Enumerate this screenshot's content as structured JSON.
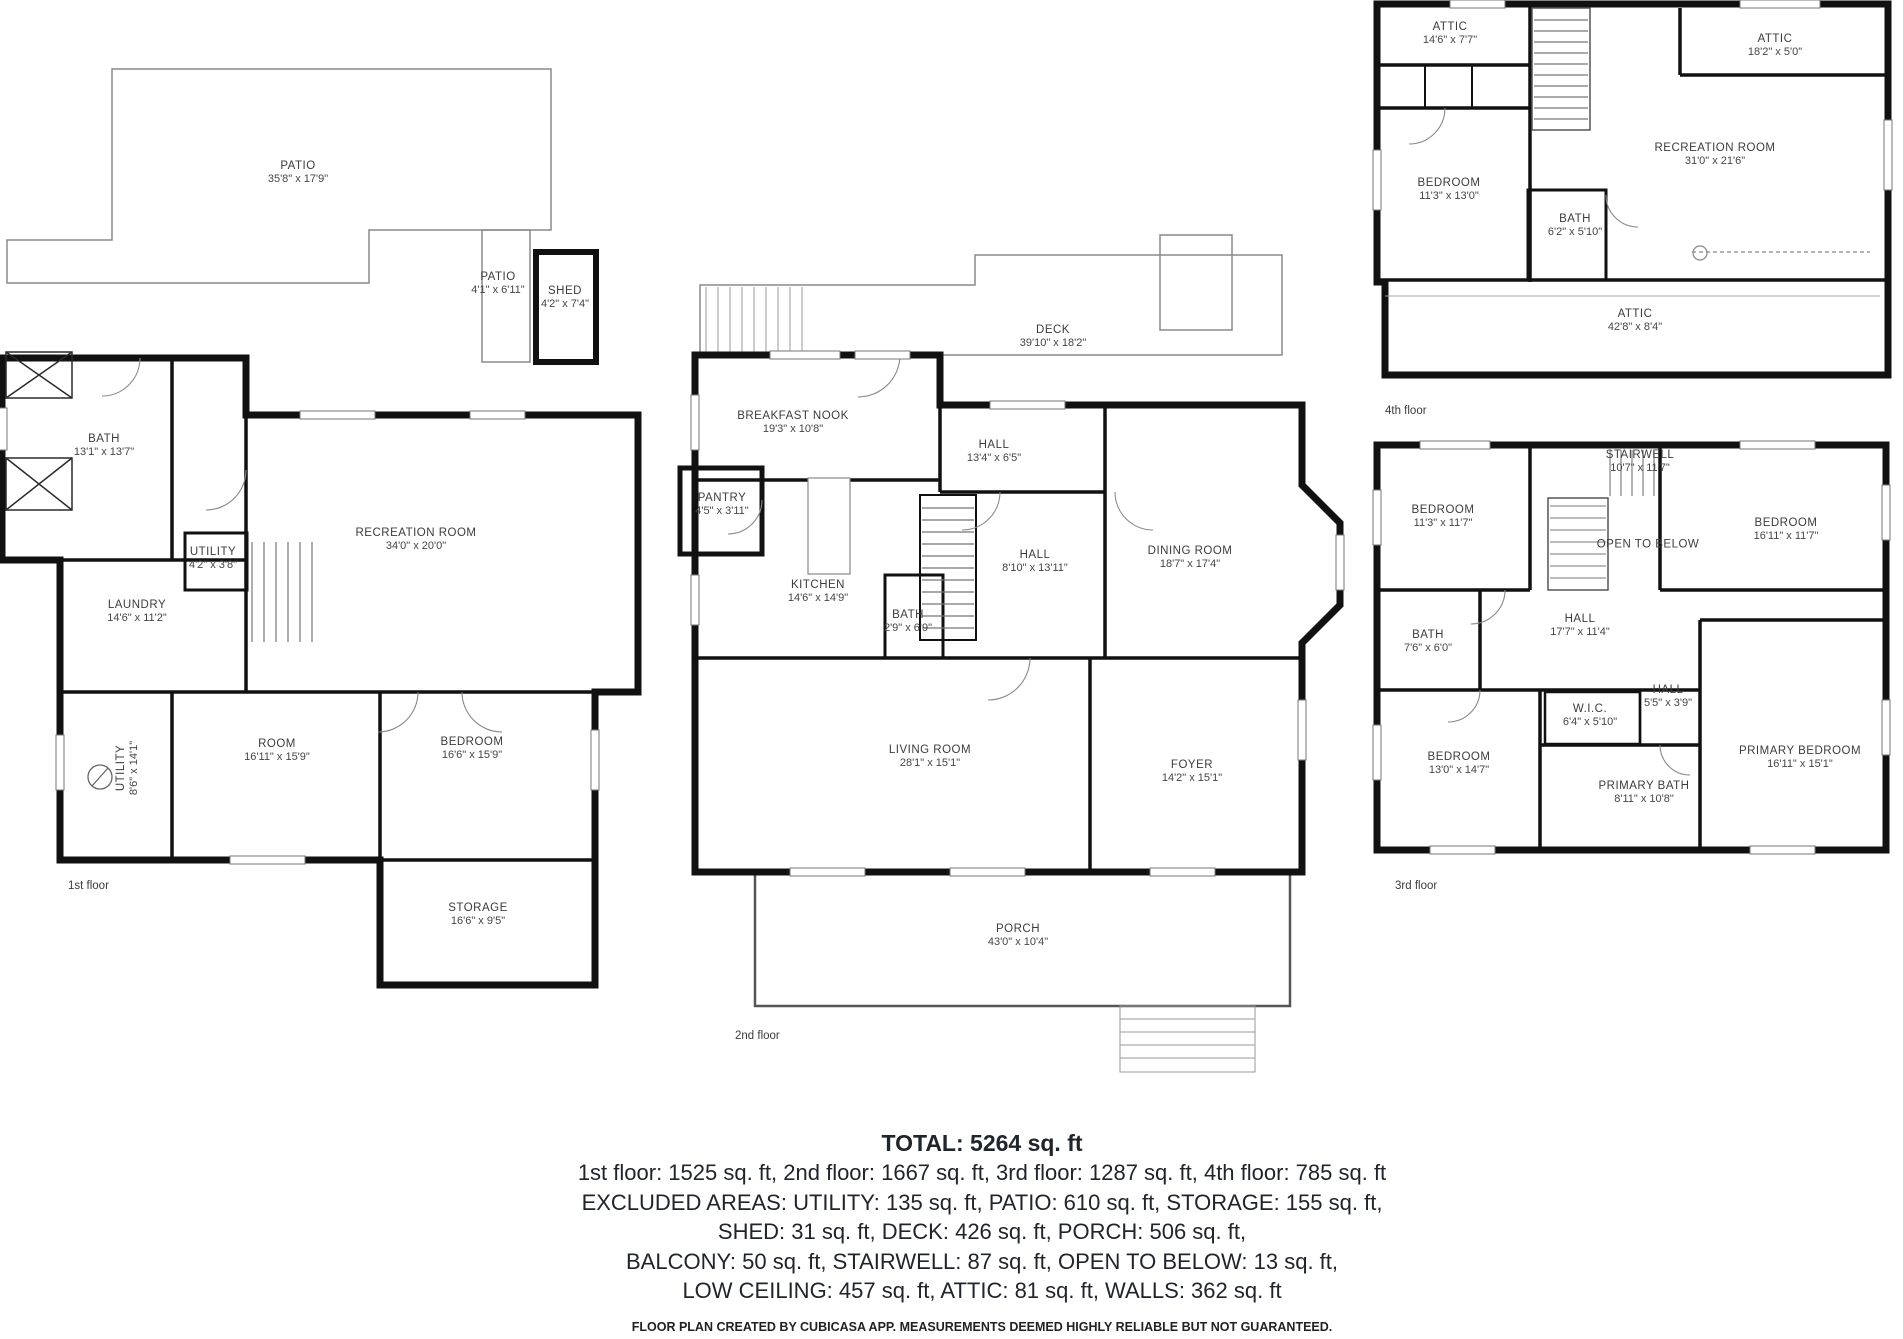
{
  "floors": [
    {
      "caption": "1st floor",
      "rooms": [
        {
          "name": "PATIO",
          "dims": "35'8\" x 17'9\""
        },
        {
          "name": "PATIO",
          "dims": "4'1\" x 6'11\""
        },
        {
          "name": "SHED",
          "dims": "4'2\" x 7'4\""
        },
        {
          "name": "BATH",
          "dims": "13'1\" x 13'7\""
        },
        {
          "name": "RECREATION ROOM",
          "dims": "34'0\" x 20'0\""
        },
        {
          "name": "UTILITY",
          "dims": "4'2\" x 3'8\""
        },
        {
          "name": "LAUNDRY",
          "dims": "14'6\" x 11'2\""
        },
        {
          "name": "UTILITY",
          "dims": "8'6\" x 14'1\""
        },
        {
          "name": "ROOM",
          "dims": "16'11\" x 15'9\""
        },
        {
          "name": "BEDROOM",
          "dims": "16'6\" x 15'9\""
        },
        {
          "name": "STORAGE",
          "dims": "16'6\" x 9'5\""
        }
      ]
    },
    {
      "caption": "2nd floor",
      "rooms": [
        {
          "name": "DECK",
          "dims": "39'10\" x 18'2\""
        },
        {
          "name": "BREAKFAST NOOK",
          "dims": "19'3\" x 10'8\""
        },
        {
          "name": "HALL",
          "dims": "13'4\" x 6'5\""
        },
        {
          "name": "PANTRY",
          "dims": "4'5\" x 3'11\""
        },
        {
          "name": "KITCHEN",
          "dims": "14'6\" x 14'9\""
        },
        {
          "name": "HALL",
          "dims": "8'10\" x 13'11\""
        },
        {
          "name": "BATH",
          "dims": "2'9\" x 6'9\""
        },
        {
          "name": "DINING ROOM",
          "dims": "18'7\" x 17'4\""
        },
        {
          "name": "LIVING ROOM",
          "dims": "28'1\" x 15'1\""
        },
        {
          "name": "FOYER",
          "dims": "14'2\" x 15'1\""
        },
        {
          "name": "PORCH",
          "dims": "43'0\" x 10'4\""
        }
      ]
    },
    {
      "caption": "3rd floor",
      "rooms": [
        {
          "name": "BEDROOM",
          "dims": "11'3\" x 11'7\""
        },
        {
          "name": "STAIRWELL",
          "dims": "10'7\" x 11'7\""
        },
        {
          "name": "OPEN TO BELOW",
          "dims": ""
        },
        {
          "name": "BEDROOM",
          "dims": "16'11\" x 11'7\""
        },
        {
          "name": "BATH",
          "dims": "7'6\" x 6'0\""
        },
        {
          "name": "HALL",
          "dims": "17'7\" x 11'4\""
        },
        {
          "name": "W.I.C.",
          "dims": "6'4\" x 5'10\""
        },
        {
          "name": "HALL",
          "dims": "5'5\" x 3'9\""
        },
        {
          "name": "BEDROOM",
          "dims": "13'0\" x 14'7\""
        },
        {
          "name": "PRIMARY BATH",
          "dims": "8'11\" x 10'8\""
        },
        {
          "name": "PRIMARY BEDROOM",
          "dims": "16'11\" x 15'1\""
        }
      ]
    },
    {
      "caption": "4th floor",
      "rooms": [
        {
          "name": "ATTIC",
          "dims": "14'6\" x 7'7\""
        },
        {
          "name": "ATTIC",
          "dims": "18'2\" x 5'0\""
        },
        {
          "name": "RECREATION ROOM",
          "dims": "31'0\" x 21'6\""
        },
        {
          "name": "BEDROOM",
          "dims": "11'3\" x 13'0\""
        },
        {
          "name": "BATH",
          "dims": "6'2\" x 5'10\""
        },
        {
          "name": "ATTIC",
          "dims": "42'8\" x 8'4\""
        }
      ]
    }
  ],
  "summary": {
    "total": "TOTAL: 5264 sq. ft",
    "lines": [
      "1st floor: 1525 sq. ft, 2nd floor: 1667 sq. ft, 3rd floor: 1287 sq. ft, 4th floor: 785 sq. ft",
      "EXCLUDED AREAS: UTILITY: 135 sq. ft, PATIO: 610 sq. ft, STORAGE: 155 sq. ft,",
      "SHED: 31 sq. ft, DECK: 426 sq. ft, PORCH: 506 sq. ft,",
      "BALCONY: 50 sq. ft, STAIRWELL: 87 sq. ft, OPEN TO BELOW: 13 sq. ft,",
      "LOW CEILING: 457 sq. ft, ATTIC: 81 sq. ft, WALLS: 362 sq. ft"
    ],
    "footer": "FLOOR PLAN CREATED BY CUBICASA APP. MEASUREMENTS DEEMED HIGHLY RELIABLE BUT NOT GUARANTEED."
  },
  "colors": {
    "wall": "#111111",
    "outdoor_outline": "#8a8a8a",
    "label_text": "#3c3c3c"
  }
}
